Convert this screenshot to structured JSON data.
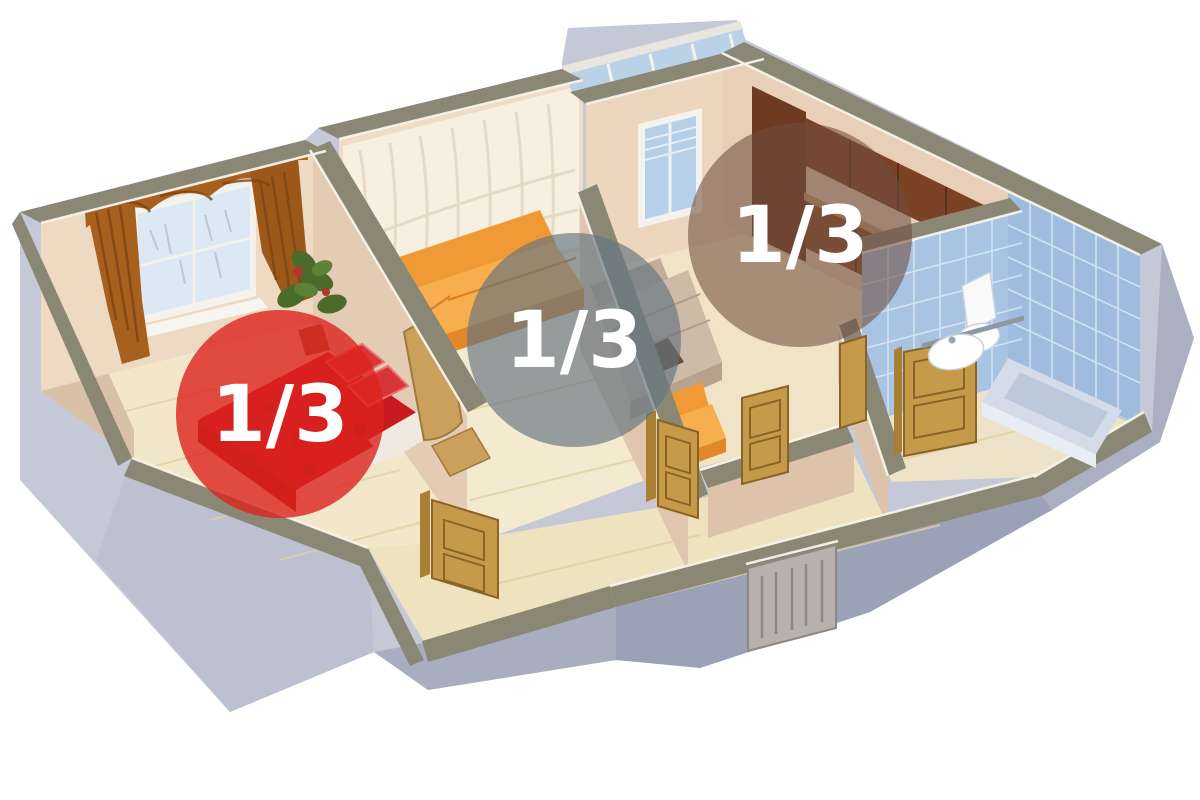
{
  "image": {
    "kind": "3d-apartment-floor-plan-render",
    "background": "#ffffff",
    "description": "Isometric cutaway apartment with three ownership-share overlays"
  },
  "overlays": {
    "shares": [
      {
        "label": "1/3",
        "area": "bedroom",
        "fill": "#dc231e",
        "opacity": "0.80"
      },
      {
        "label": "1/3",
        "area": "living-room",
        "fill": "#64747f",
        "opacity": "0.66"
      },
      {
        "label": "1/3",
        "area": "kitchen",
        "fill": "#6e4e40",
        "opacity": "0.58"
      }
    ]
  },
  "palette": {
    "wall_top": "#8a8775",
    "exterior_light": "#c5c9d7",
    "exterior_dark": "#9ba1b6",
    "interior_wall": "#ecd9c2",
    "floor": "#f3e7c9",
    "tile_blue": "#a9c4e3",
    "door_wood": "#c59a48",
    "sofa_orange": "#f09a36",
    "bed_red": "#c81a1f",
    "curtain_brown": "#a8601f"
  }
}
